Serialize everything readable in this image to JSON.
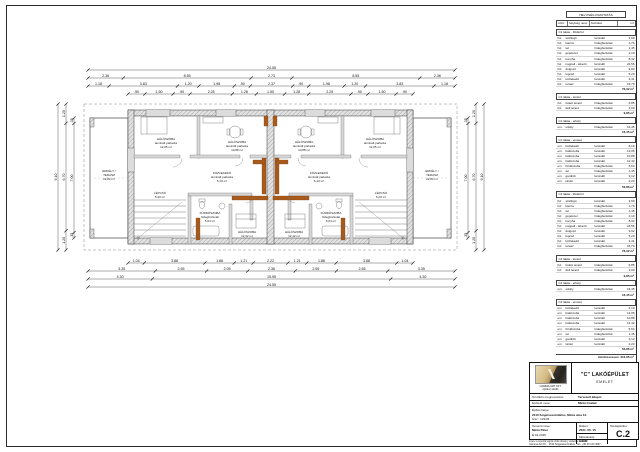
{
  "schedule": {
    "title": "HELYISÉG KIMUTATÁS",
    "columns": [
      "szint",
      "helyiség neve",
      "burkolat",
      "m²"
    ],
    "sections": [
      {
        "name": "C1 lakás - földszint",
        "rows": [
          [
            "fsz.",
            "szélfogó",
            "laminált",
            "3,90"
          ],
          [
            "fsz.",
            "kamra",
            "hidegburkolat",
            "1,76"
          ],
          [
            "fsz.",
            "wc",
            "hidegburkolat",
            "1,45"
          ],
          [
            "fsz.",
            "gépészet",
            "hidegburkolat",
            "2,10"
          ],
          [
            "fsz.",
            "konyha",
            "hidegburkolat",
            "8,32"
          ],
          [
            "fsz.",
            "nappali - étkező",
            "laminált",
            "24,56"
          ],
          [
            "fsz.",
            "dolgozó",
            "laminált",
            "9,92"
          ],
          [
            "fsz.",
            "lépcső",
            "laminált",
            "5,20"
          ],
          [
            "fsz.",
            "közlekedő",
            "laminált",
            "3,41"
          ],
          [
            "fsz.",
            "terasz",
            "hidegburkolat",
            "15,70"
          ]
        ],
        "subtotal": "76,32 m²"
      },
      {
        "name": "C1 lakás - terasz",
        "rows": [
          [
            "fsz.",
            "fedett terasz",
            "hidegburkolat",
            "6,85"
          ],
          [
            "fsz.",
            "déli terasz",
            "hidegburkolat",
            "3,00"
          ]
        ],
        "subtotal": "9,85 m²"
      },
      {
        "name": "C1 lakás - erkély",
        "rows": [
          [
            "em.",
            "erkély",
            "hidegburkolat",
            "16,45"
          ]
        ],
        "subtotal": "16,45 m²"
      },
      {
        "name": "C1 lakás - emelet",
        "rows": [
          [
            "em.",
            "közlekedő",
            "laminált",
            "6,10"
          ],
          [
            "em.",
            "hálószoba",
            "laminált",
            "12,05"
          ],
          [
            "em.",
            "hálószoba",
            "laminált",
            "10,88"
          ],
          [
            "em.",
            "hálószoba",
            "laminált",
            "12,42"
          ],
          [
            "em.",
            "fürdőszoba",
            "hidegburkolat",
            "5,64"
          ],
          [
            "em.",
            "wc",
            "hidegburkolat",
            "1,45"
          ],
          [
            "em.",
            "gardrób",
            "laminált",
            "3,12"
          ],
          [
            "em.",
            "tároló",
            "laminált",
            "2,20"
          ]
        ],
        "subtotal": "53,86 m²"
      },
      {
        "name": "C2 lakás - földszint",
        "rows": [
          [
            "fsz.",
            "szélfogó",
            "laminált",
            "3,90"
          ],
          [
            "fsz.",
            "kamra",
            "hidegburkolat",
            "1,76"
          ],
          [
            "fsz.",
            "wc",
            "hidegburkolat",
            "1,45"
          ],
          [
            "fsz.",
            "gépészet",
            "hidegburkolat",
            "2,10"
          ],
          [
            "fsz.",
            "konyha",
            "hidegburkolat",
            "8,32"
          ],
          [
            "fsz.",
            "nappali - étkező",
            "laminált",
            "24,56"
          ],
          [
            "fsz.",
            "dolgozó",
            "laminált",
            "9,92"
          ],
          [
            "fsz.",
            "lépcső",
            "laminált",
            "5,20"
          ],
          [
            "fsz.",
            "közlekedő",
            "laminált",
            "3,41"
          ],
          [
            "fsz.",
            "terasz",
            "hidegburkolat",
            "15,70"
          ]
        ],
        "subtotal": "76,32 m²"
      },
      {
        "name": "C2 lakás - terasz",
        "rows": [
          [
            "fsz.",
            "fedett terasz",
            "hidegburkolat",
            "6,85"
          ],
          [
            "fsz.",
            "déli terasz",
            "hidegburkolat",
            "3,00"
          ]
        ],
        "subtotal": "9,85 m²"
      },
      {
        "name": "C2 lakás - erkély",
        "rows": [
          [
            "em.",
            "erkély",
            "hidegburkolat",
            "16,45"
          ]
        ],
        "subtotal": "16,45 m²"
      },
      {
        "name": "C2 lakás - emelet",
        "rows": [
          [
            "em.",
            "közlekedő",
            "laminált",
            "6,10"
          ],
          [
            "em.",
            "hálószoba",
            "laminált",
            "12,05"
          ],
          [
            "em.",
            "hálószoba",
            "laminált",
            "10,88"
          ],
          [
            "em.",
            "hálószoba",
            "laminált",
            "12,42"
          ],
          [
            "em.",
            "fürdőszoba",
            "hidegburkolat",
            "5,64"
          ],
          [
            "em.",
            "wc",
            "hidegburkolat",
            "1,45"
          ],
          [
            "em.",
            "gardrób",
            "laminált",
            "3,12"
          ],
          [
            "em.",
            "tároló",
            "laminált",
            "2,20"
          ]
        ],
        "subtotal": "53,86 m²"
      }
    ],
    "total_label": "mindösszesen:",
    "total": "312,96 m²"
  },
  "titleblock": {
    "logo_caption1": "GAMMA-ART KFT.",
    "logo_caption2": "építész stúdió",
    "project_title": "\"C\" LAKÓÉPÜLET",
    "project_subtitle": "EMELET",
    "phase_label": "Tervfázis megnevezése:",
    "phase_value": "Tervezett állapot",
    "client_label": "Építtető neve:",
    "client_value": "Minta Család",
    "site_label": "Építés helye:",
    "site_line1": "2310 Szigetszentmiklós, Minta utca 12.",
    "site_line2": "hrsz.: 1234/5",
    "designer_label": "Tervező neve:",
    "designer_line1": "Minta Péter",
    "designer_line2": "É 01-2345",
    "date_label": "Dátum:",
    "date_value": "2021. 06. 15.",
    "scale_label": "Méretarány:",
    "scale_value": "1:100",
    "sheetno_label": "Tervlapszám:",
    "sheetno_value": "C.2",
    "footer1": "A terv a szerzői jogról szóló törvény védelme alatt áll!",
    "footer2": "Gamma-Art Kft. · 2310 Szigetszentmiklós · tel.: +36 30 123 4567"
  },
  "plan": {
    "rooms": {
      "bedroom_a": {
        "name": "HÁLÓSZOBA",
        "finish": "laminált parketta",
        "area": "12,05 m²"
      },
      "bedroom_b": {
        "name": "HÁLÓSZOBA",
        "finish": "laminált parketta",
        "area": "10,88 m²"
      },
      "bedroom_c": {
        "name": "HÁLÓSZOBA",
        "finish": "laminált parketta",
        "area": "12,42 m²"
      },
      "corridor": {
        "name": "KÖZLEKEDŐ",
        "finish": "laminált parketta",
        "area": "6,10 m²"
      },
      "bath": {
        "name": "FÜRDŐSZOBA",
        "finish": "hidegburkolat",
        "area": "5,64 m²"
      },
      "stairs": {
        "name": "LÉPCSŐ",
        "finish": "laminált parketta",
        "area": "5,20 m²"
      },
      "terrace": {
        "name": "ERKÉLY /",
        "finish": "TERASZ",
        "area": "22,84 m²"
      }
    },
    "dims": {
      "t1": [
        "24.55"
      ],
      "t2": [
        "2.36",
        "8.55",
        "2.73",
        "8.55",
        "2.36"
      ],
      "t3": [
        "1.18",
        "3.83",
        "1.20",
        "1.98",
        ".90",
        "2.37",
        ".90",
        "1.98",
        "1.20",
        "3.83",
        "1.18"
      ],
      "t4": [
        ".90",
        "1.50",
        ".90",
        "2.25",
        "1.28",
        "1.50",
        "1.28",
        "2.25",
        ".90",
        "1.50",
        ".90"
      ],
      "b1": [
        "1.04",
        "3.88",
        "1.88",
        "1.21",
        "2.22",
        "1.21",
        "1.88",
        "3.88",
        "1.04"
      ],
      "b2": [
        "3.35",
        "2.55",
        "2.05",
        "2.36",
        "2.05",
        "2.55",
        "3.35"
      ],
      "b3": [
        "4.30",
        "15.95",
        "4.30"
      ],
      "b4": [
        "24.55"
      ],
      "l1": [
        "9.10"
      ],
      "l2": [
        "1.20",
        "6.70",
        "1.20"
      ],
      "l3": [
        ".35",
        "7.00",
        ".35"
      ],
      "r1": [
        "9.10"
      ],
      "r2": [
        "1.20",
        "6.70",
        "1.20"
      ],
      "r3": [
        ".35",
        "7.00",
        ".35"
      ]
    }
  }
}
